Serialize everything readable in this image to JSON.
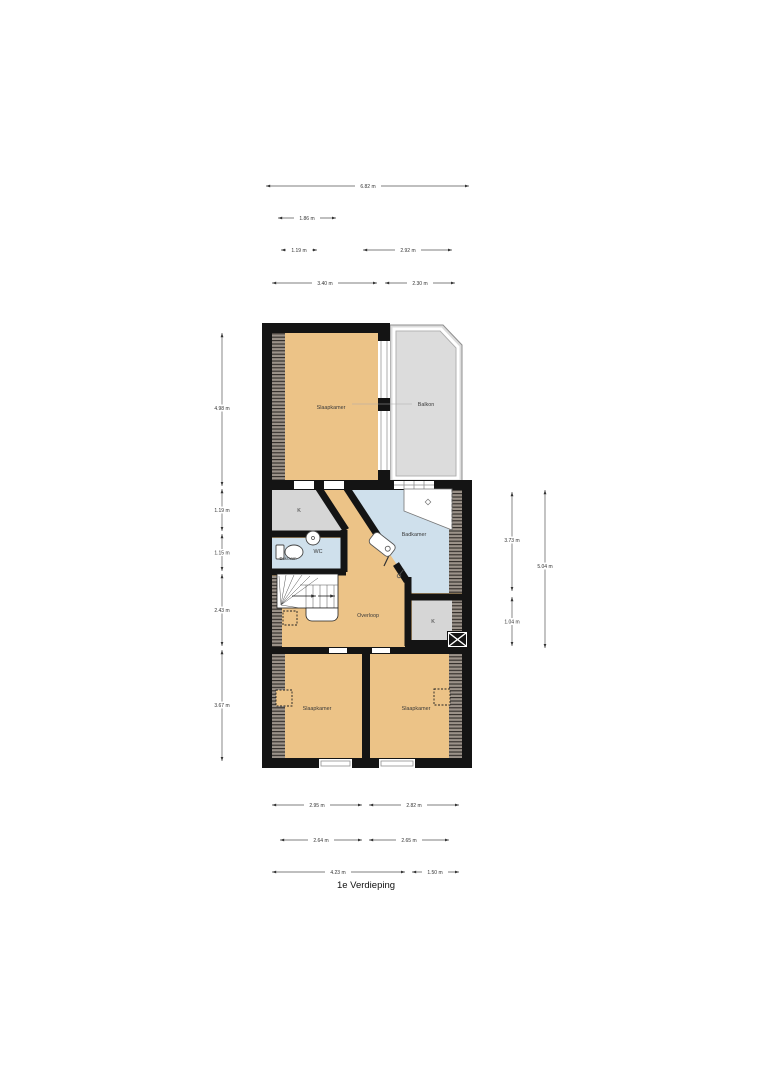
{
  "title": "1e Verdieping",
  "rooms": {
    "slaapkamer_top": "Slaapkamer",
    "balkon": "Balkon",
    "kast_top": "K",
    "wc": "WC",
    "dakraam": "Dakraam",
    "badkamer": "Badkamer",
    "overloop": "Overloop",
    "kast_right": "K",
    "slaapkamer_left": "Slaapkamer",
    "slaapkamer_right": "Slaapkamer"
  },
  "dimensions": {
    "top_total": "6.82 m",
    "top_row2": "1.86 m",
    "top_row3_left": "1.19 m",
    "top_row3_right": "2.92 m",
    "top_row4_left": "3.40 m",
    "top_row4_right": "2.30 m",
    "left_1": "4.98 m",
    "left_2": "1.19 m",
    "left_3": "1.15 m",
    "left_4": "2.43 m",
    "left_5": "3.67 m",
    "right_inner_top": "3.73 m",
    "right_inner_bottom": "1.04 m",
    "right_outer": "5.04 m",
    "bottom_row1_left": "2.95 m",
    "bottom_row1_right": "2.82 m",
    "bottom_row2_left": "2.64 m",
    "bottom_row2_right": "2.65 m",
    "bottom_row3_left": "4.23 m",
    "bottom_row3_right": "1.50 m"
  },
  "colors": {
    "room_orange": "#ecc387",
    "room_blue": "#cfe0ec",
    "room_gray": "#d6d6d6",
    "balcony_gray": "#dcdcdc",
    "wall_black": "#141414",
    "hatch_base": "#9b9289"
  }
}
